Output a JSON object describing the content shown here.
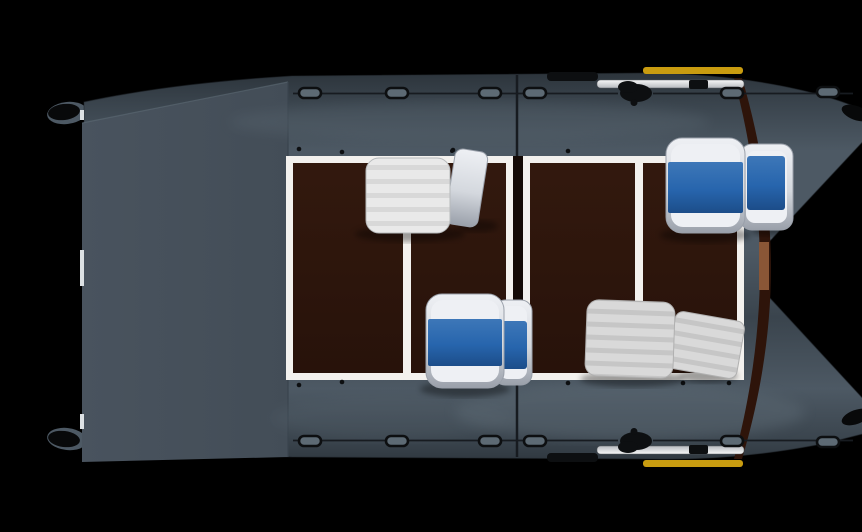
{
  "scene": {
    "alt": "Top view 3D render of a grey inflatable catamaran boat with dark brown deck, four seats (two blue-cushion bucket seats, one white inflatable bench, one grey inflatable bench), two stowed oars with yellow blade tips, rope grab handles along both tubes, on a black background",
    "object": "inflatable catamaran boat - top view",
    "style": "3d product render",
    "background": "#000000"
  },
  "colors": {
    "background": "#000000",
    "hull-edge": "#2c343b",
    "hull-dark": "#3a444d",
    "hull-mid": "#4d5964",
    "hull-light": "#5d6a74",
    "panel": "#49535e",
    "panel-dark": "#434d57",
    "floor-brown": "#27120a",
    "floor-brown-light": "#33190e",
    "floor-frame": "#f3f1ee",
    "gap-dark": "#140a06",
    "transom-band": "#2e140a",
    "wood-patch": "#8a5636",
    "seat-white": "#e9e9e9",
    "seat-white-rib": "#d8d8d8",
    "seat-gray": "#d9d9d9",
    "seat-gray-rib": "#c6c6c6",
    "shell-light": "#eef0f4",
    "shell-mid": "#d4d8de",
    "shell-dark": "#9aa0aa",
    "cushion-blue": "#2765ad",
    "cushion-blue-dark": "#1c4d89",
    "cushion-blue-light": "#3d77b8",
    "accent-yellow": "#c99c10",
    "fitting-black": "#0d0f11",
    "rope": "#171b20",
    "metal-light": "#f7f8f8",
    "metal-dark": "#b7babf",
    "tip-black": "#08090a",
    "white-strip": "#dde1e4"
  },
  "parts": {
    "hull": "slate-grey inflatable tubes",
    "bow-cones": "two pointed tube cones with black rub patches (right end)",
    "stern-panel": "flat grey fabric panel (left end)",
    "deck-floor": "dark brown deck, four panels in white frame",
    "seat-bow-bench": "white ribbed inflatable bench with backrest",
    "seat-stern-bench": "grey ribbed inflatable bench with backrest",
    "seat-helm-port": "white bucket seat with blue cushion",
    "seat-helm-starboard": "white bucket seat with blue cushion",
    "oars": "two stowed oars, silver shafts, black blades",
    "accent-stripes": "yellow oar-blade stripes",
    "grab-handles": "rope grab handles along both tubes",
    "oarlocks": "black oarlocks, one per side"
  },
  "counts": {
    "seats": 4,
    "oars": 2,
    "grab_handles": 12,
    "deck_panels": 4
  }
}
